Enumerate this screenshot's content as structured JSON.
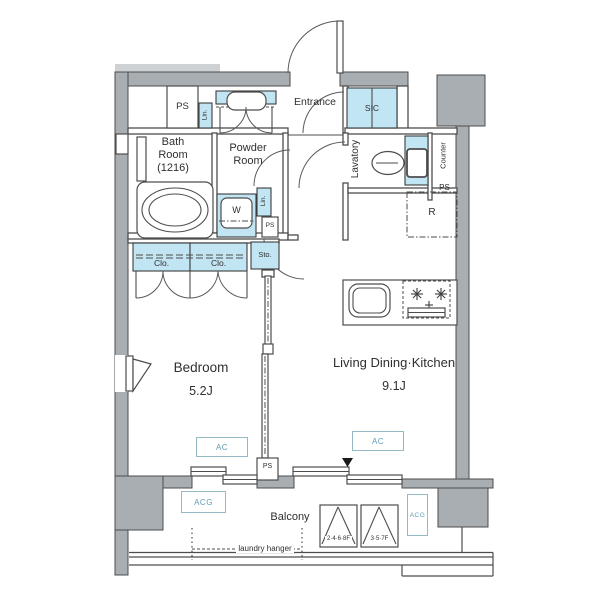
{
  "rooms": {
    "bedroom": "Bedroom",
    "bedroom_size": "5.2J",
    "ldk": "Living Dining·Kitchen",
    "ldk_size": "9.1J",
    "bath1": "Bath",
    "bath2": "Room",
    "bath3": "(1216)",
    "powder1": "Powder",
    "powder2": "Room",
    "entrance": "Entrance",
    "lavatory": "Lavatory",
    "balcony": "Balcony",
    "sic": "SIC",
    "counter": "Counter"
  },
  "equipment": {
    "fridge": "R",
    "washer": "W",
    "storage": "Sto.",
    "closet": "Clo.",
    "linen": "Lin.",
    "pipe_space": "PS",
    "ac": "AC",
    "acg": "ACG",
    "laundry": "laundry hanger",
    "hatch_even": "2·4·6·8F",
    "hatch_odd": "3·5·7F"
  },
  "colors": {
    "wall_gray": "#a9aeb2",
    "fixture_blue": "#c2e5f4",
    "accent_teal": "#5f9db3",
    "line": "#4d4d4d"
  }
}
